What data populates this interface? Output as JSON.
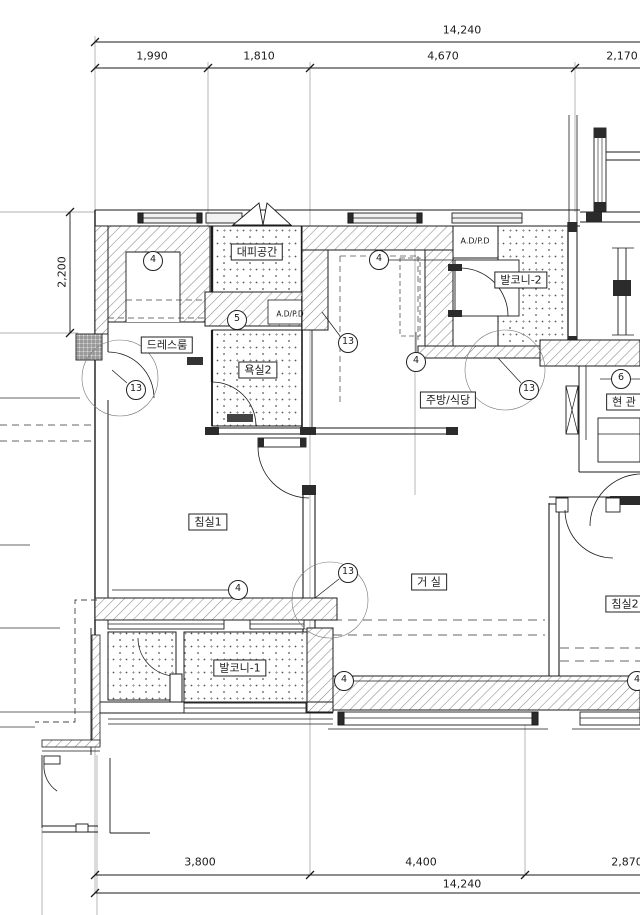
{
  "drawing": {
    "dims_top": {
      "overall": "14,240",
      "seg1": "1,990",
      "seg2": "1,810",
      "seg3": "4,670",
      "seg4": "2,170"
    },
    "dims_bottom": {
      "overall": "14,240",
      "seg1": "3,800",
      "seg2": "4,400",
      "seg3": "2,870"
    },
    "dims_left": {
      "seg1": "2,200"
    },
    "rooms": {
      "refuge": "대피공간",
      "dress": "드레스룸",
      "bath2": "욕실2",
      "balcony2": "발코니-2",
      "kitchen": "주방/식당",
      "entry": "현 관",
      "bed1": "침실1",
      "living": "거 실",
      "balcony1": "발코니-1",
      "bed2": "침실2"
    },
    "shaft_label": "A.D/P.D",
    "markers": {
      "n4": "4",
      "n5": "5",
      "n6": "6",
      "n13": "13"
    },
    "colors": {
      "line": "#1b1b1b",
      "hatch": "#8a8a8a",
      "paper": "#ffffff"
    }
  }
}
